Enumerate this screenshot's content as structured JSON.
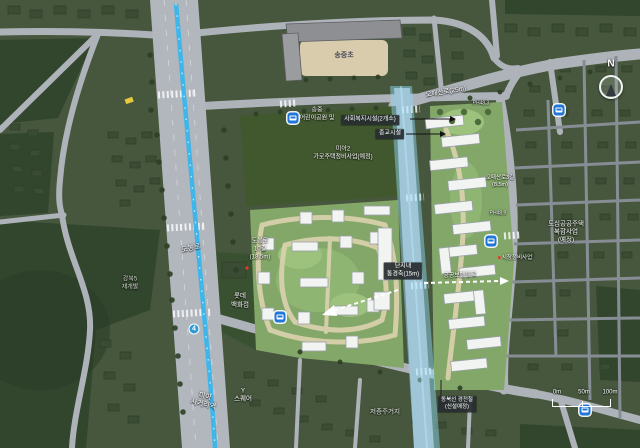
{
  "labels": {
    "school": "송중초",
    "childrens_park_line1": "송중",
    "childrens_park_line2": "어린이공원 및",
    "welfare_facility": "사회복지시설(2개소)",
    "religious_facility": "종교시설",
    "mia2_line1": "미아2",
    "mia2_line2": "가로주택정비사업(예정)",
    "opaesan_ro": "오패산로(25m)",
    "opaesan_3gil_line1": "오패산로3길",
    "opaesan_3gil_line2": "(8.5m)",
    "ph_marker_a": "PH48.3",
    "ph_marker_b": "PH48.9",
    "dobong_ro": "도봉로",
    "dobong_10gil_line1": "도봉로",
    "dobong_10gil_line2": "10길",
    "dobong_10gil_line3": "(18.5m)",
    "gangbuk5_line1": "강북5",
    "gangbuk5_line2": "재개발",
    "lotte_line1": "롯데",
    "lotte_line2": "백화점",
    "subway_line4": "4",
    "mia_station_line1": "미아",
    "mia_station_line2": "사거리역",
    "y_square_line1": "Y",
    "y_square_line2": "스퀘어",
    "corridor_line1": "단지내",
    "corridor_line2": "통경축(15m)",
    "public_walkway": "공공보행통로",
    "market": "시장정비사업",
    "dosim_line1": "도심공공주택",
    "dosim_line2": "복합사업",
    "dosim_line3": "(예정)",
    "lowrise": "저층주거지",
    "dongbuk_line1": "동북선 경전철",
    "dongbuk_line2": "(신설예정)",
    "compass_n": "N"
  },
  "scale_bar": {
    "start": "0m",
    "mid": "50m",
    "end": "100m"
  },
  "colors": {
    "subway_line4": "#3fb6ea",
    "planned_rail_band": "#8ed8f4",
    "bus_icon_bg": "#2176d9",
    "annotation_badge_bg": "#282d30",
    "site_green": "#83a768",
    "path_beige": "#d8d1ab",
    "road_gray": "#aeb3ba"
  }
}
